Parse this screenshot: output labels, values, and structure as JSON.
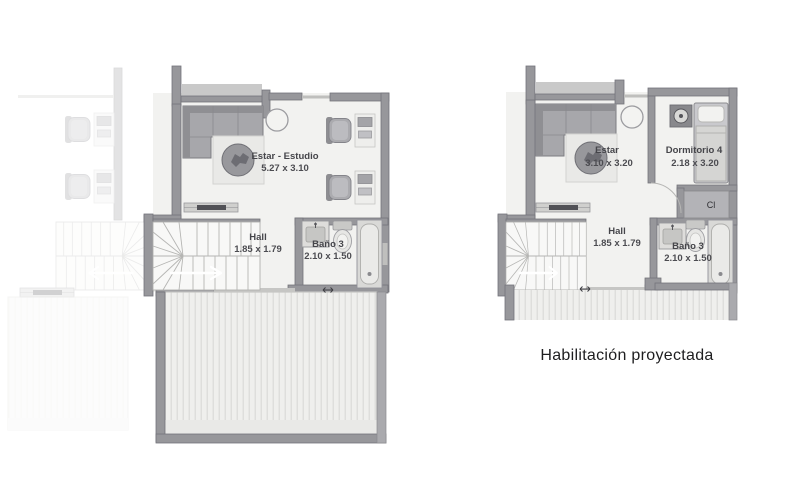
{
  "colors": {
    "background": "#ffffff",
    "wall": "#97979b",
    "wall_light": "#c9c9c9",
    "room_fill": "#f2f2f0",
    "furniture": "#a8a8ac",
    "label_text": "#45454a",
    "caption_text": "#1e1e20"
  },
  "left_plan": {
    "rooms": {
      "estar_estudio": {
        "label": "Estar - Estudio",
        "dims": "5.27 x 3.10"
      },
      "hall": {
        "label": "Hall",
        "dims": "1.85 x 1.79"
      },
      "bano_3": {
        "label": "Baño 3",
        "dims": "2.10 x 1.50"
      }
    }
  },
  "right_plan": {
    "rooms": {
      "estar": {
        "label": "Estar",
        "dims": "3.10 x 3.20"
      },
      "dormitorio_4": {
        "label": "Dormitorio 4",
        "dims": "2.18 x 3.20"
      },
      "hall": {
        "label": "Hall",
        "dims": "1.85 x 1.79"
      },
      "bano_3": {
        "label": "Baño 3",
        "dims": "2.10 x 1.50"
      },
      "closet": {
        "label": "Cl"
      }
    },
    "caption": "Habilitación proyectada"
  }
}
